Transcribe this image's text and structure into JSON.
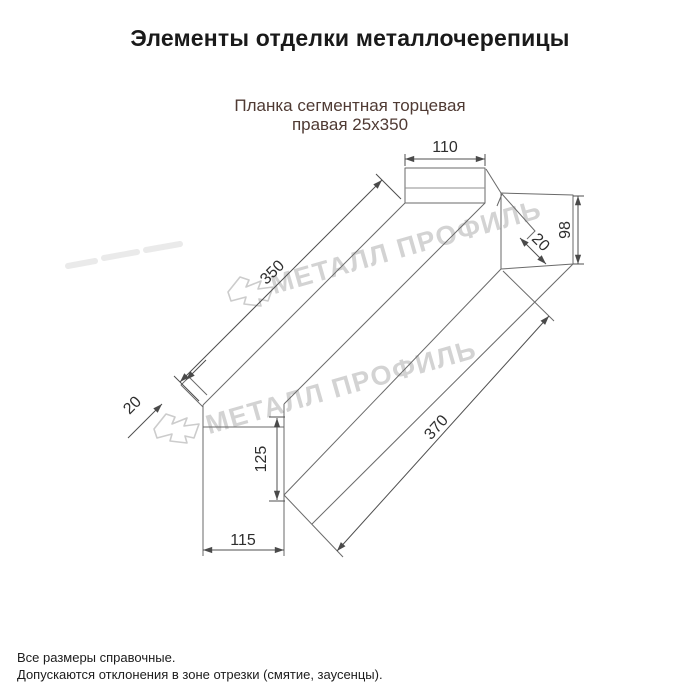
{
  "title": "Элементы отделки металлочерепицы",
  "subtitle": {
    "line1": "Планка сегментная торцевая",
    "line2": "правая 25x350"
  },
  "watermark": {
    "text": "МЕТАЛЛ ПРОФИЛЬ",
    "color": "#d3d3d3",
    "logo_color": "#cccccc"
  },
  "dims": {
    "flange_width": "110",
    "end_height": "98",
    "end_fold": "20",
    "top_length": "350",
    "left_fold": "20",
    "left_height": "125",
    "bottom_width": "115",
    "bottom_length": "370"
  },
  "footer": {
    "line1": "Все размеры справочные.",
    "line2": "Допускаются отклонения в зоне отрезки (смятие, заусенцы)."
  },
  "colors": {
    "title_text": "#1a1a1a",
    "subtitle_text": "#4f3a33",
    "outline": "#6a6a6a",
    "dimension_line": "#4f4f4f",
    "dimension_text": "#2e2e2e",
    "footer_text": "#1c1c1c"
  }
}
